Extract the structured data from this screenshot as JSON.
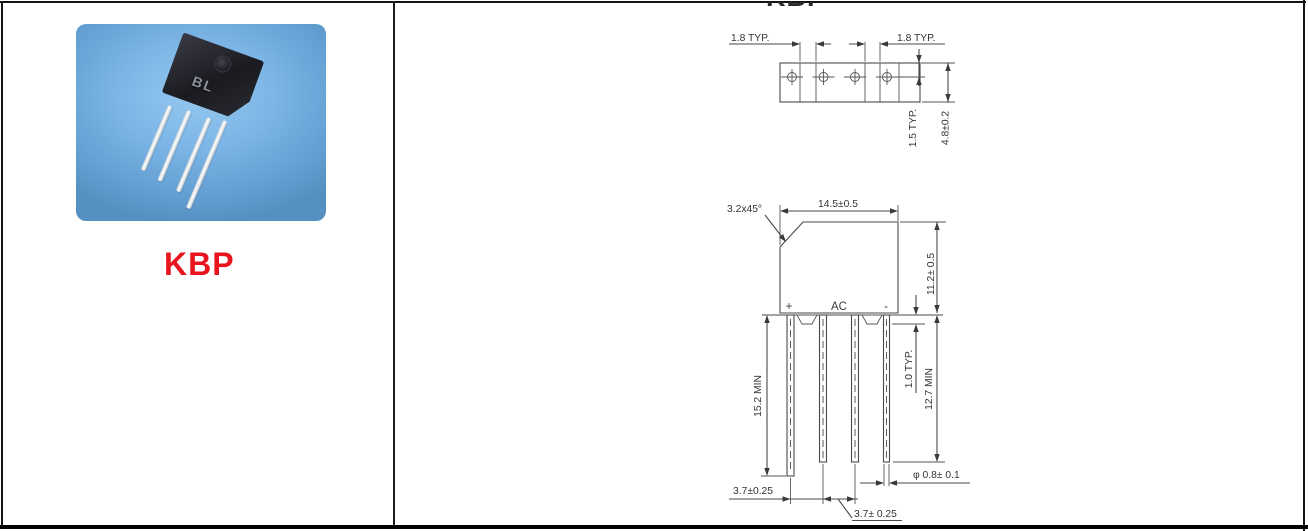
{
  "page": {
    "clipped_top_title": "KBP"
  },
  "left_panel": {
    "part_name": "KBP",
    "part_marking": "BL"
  },
  "colors": {
    "part_name_red": "#e8141e",
    "photo_blue": "#7cb5e6",
    "drawing_line_gray": "#4a4a4a"
  },
  "drawing": {
    "top_view": {
      "pitch_left": "1.8 TYP.",
      "pitch_right": "1.8 TYP.",
      "lead_offset": "1.5 TYP.",
      "body_thickness": "4.8±0.2"
    },
    "front_view": {
      "body_width": "14.5±0.5",
      "chamfer": "3.2x45°",
      "body_height": "11.2± 0.5",
      "pin_plus": "+",
      "pin_ac": "AC",
      "pin_minus": "-",
      "lead_length_long": "15.2 MIN",
      "standoff": "1.0 TYP.",
      "lead_length_min": "12.7 MIN",
      "lead_diameter": "φ 0.8± 0.1",
      "lead_pitch_1": "3.7±0.25",
      "lead_pitch_2": "3.7± 0.25"
    }
  }
}
